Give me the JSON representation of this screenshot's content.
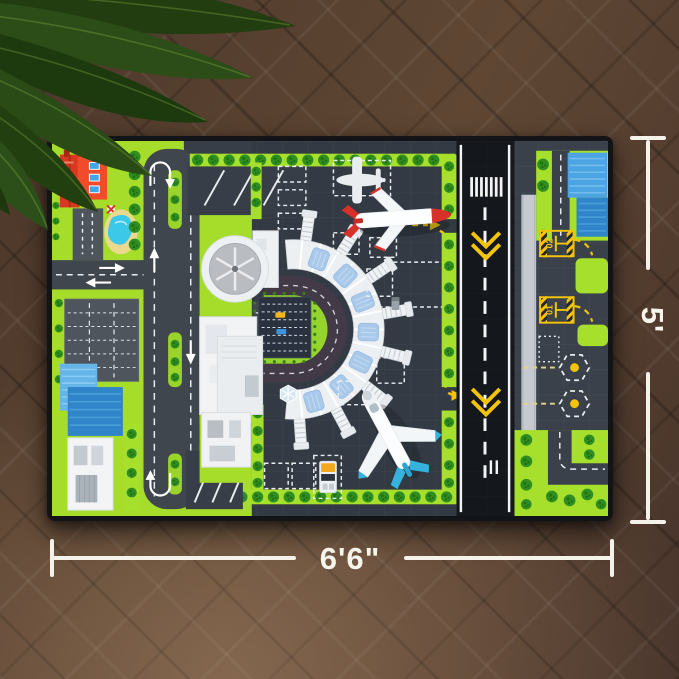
{
  "scene": {
    "description": "Top-down product photo of an airport runway play mat rug lying on a dark herringbone wood floor, green houseplant leaves in the top-left corner, white size dimension lines drawn beside the mat",
    "floor_color": "#57402f",
    "plant_leaf_color": "#2a4a15"
  },
  "dimensions": {
    "width_label": "6'6\"",
    "height_label": "5'",
    "line_color": "#f5f2ea"
  },
  "mat": {
    "theme": "airport-city-playmat",
    "border_color": "#131417",
    "colors": {
      "grass": "#a6dd2b",
      "road": "#3f464e",
      "apron": "#333a43",
      "runway": "#14181d",
      "runway_marking_white": "#f2f3f4",
      "taxi_line_yellow": "#f3c409",
      "terminal_white": "#eef1f4",
      "glass_blue": "#a9c9ea",
      "loop_road_purple": "#423a46",
      "pool_water": "#3cc9e9",
      "pool_deck": "#ead98e",
      "house_roof_red": "#e8472e",
      "building_blue": "#4da4e2",
      "tree_green": "#2f8e20",
      "parking_navy": "#2a3240"
    },
    "runway": {
      "holding_point_labels": [
        "02",
        "01"
      ],
      "chevron_color": "#f3c409"
    }
  },
  "toys": {
    "red_airplane": {
      "body": "#fdfeff",
      "accent": "#d8312a"
    },
    "blue_airplane": {
      "body": "#fcfdfe",
      "accent": "#35b3dd"
    },
    "small_airplane_marking": "#e9edf0"
  }
}
